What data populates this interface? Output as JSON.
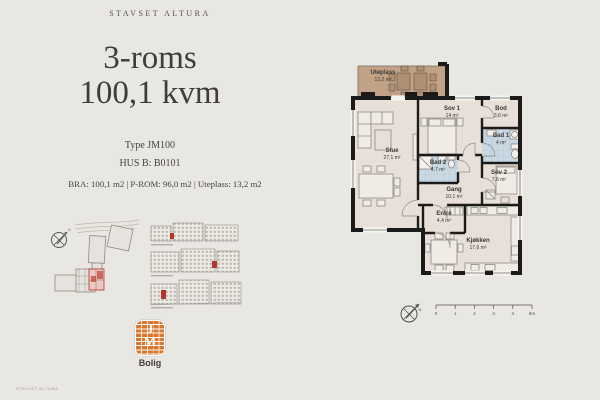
{
  "header": {
    "brand": "STAVSET ALTURA"
  },
  "title": {
    "line1": "3-roms",
    "line2": "100,1 kvm"
  },
  "unit": {
    "type_label": "Type JM100",
    "house_label": "HUS B: B0101"
  },
  "specs_line": "BRA: 100,1 m2 | P-ROM: 96,0 m2 | Uteplass: 13,2 m2",
  "floorplan": {
    "rooms": [
      {
        "id": "uteplass",
        "name": "Uteplass",
        "area": "13,2 m²"
      },
      {
        "id": "stue",
        "name": "Stue",
        "area": "27,1 m²"
      },
      {
        "id": "sov1",
        "name": "Sov 1",
        "area": "14 m²"
      },
      {
        "id": "bod",
        "name": "Bod",
        "area": "3,6 m²"
      },
      {
        "id": "bad1",
        "name": "Bad 1",
        "area": "4 m²"
      },
      {
        "id": "bad2",
        "name": "Bad 2",
        "area": "4,7 m²"
      },
      {
        "id": "gang",
        "name": "Gang",
        "area": "10,1 m²"
      },
      {
        "id": "sov2",
        "name": "Sov 2",
        "area": "7,6 m²"
      },
      {
        "id": "entre",
        "name": "Entré",
        "area": "4,4 m²"
      },
      {
        "id": "kjokken",
        "name": "Kjøkken",
        "area": "17,6 m²"
      }
    ],
    "colors": {
      "floor": "#e8dfd8",
      "terrace": "#c2a286",
      "bath": "#c9d8e2",
      "wall": "#1c1b19",
      "accent_red": "#b5342c"
    }
  },
  "scalebar": {
    "ticks": [
      "0",
      "1",
      "2",
      "3",
      "4",
      "5m"
    ]
  },
  "compass": {
    "north": "N"
  },
  "logo": {
    "letters": [
      "J",
      "M"
    ],
    "name": "Bolig"
  },
  "footer_text": "STAVSET ALTURA"
}
